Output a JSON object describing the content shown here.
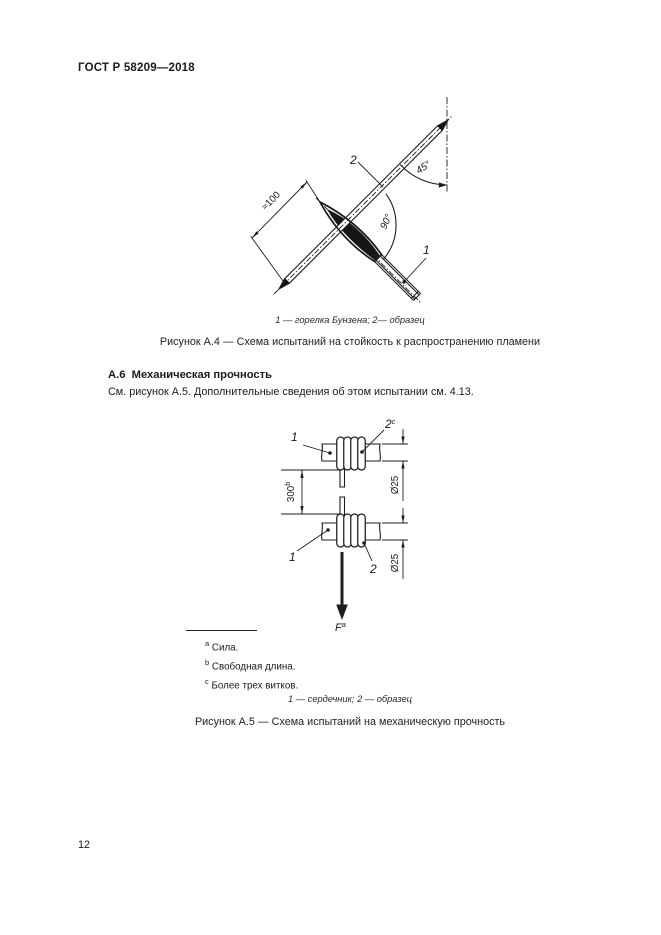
{
  "page": {
    "header": "ГОСТ Р 58209—2018",
    "number": "12"
  },
  "figure_a4": {
    "callout_sample": "2",
    "callout_burner": "1",
    "angle_sample_vertical": "45°",
    "angle_burner_sample": "90°",
    "dim_length": "≈100",
    "legend": "1 — горелка Бунзена; 2— образец",
    "caption": "Рисунок А.4 — Схема испытаний на стойкость к распространению пламени"
  },
  "section_a6": {
    "heading": "А.6  Механическая прочность",
    "body": "См. рисунок А.5. Дополнительные сведения об этом испытании см. 4.13."
  },
  "figure_a5": {
    "callout_core_top": "1",
    "callout_core_bottom": "1",
    "callout_sample_top": "2",
    "callout_sample_top_sup": "c",
    "callout_sample_bottom": "2",
    "dim_free_length": "300",
    "dim_free_length_sup": "b",
    "dim_diameter_top": "Ø25",
    "dim_diameter_bottom": "Ø25",
    "force": "F",
    "force_sup": "a",
    "footnotes": [
      {
        "marker": "a",
        "text": "Сила."
      },
      {
        "marker": "b",
        "text": "Свободная длина."
      },
      {
        "marker": "c",
        "text": "Более трех витков."
      }
    ],
    "legend": "1 — сердечник; 2 — образец",
    "caption": "Рисунок А.5 — Схема испытаний на механическую прочность"
  }
}
